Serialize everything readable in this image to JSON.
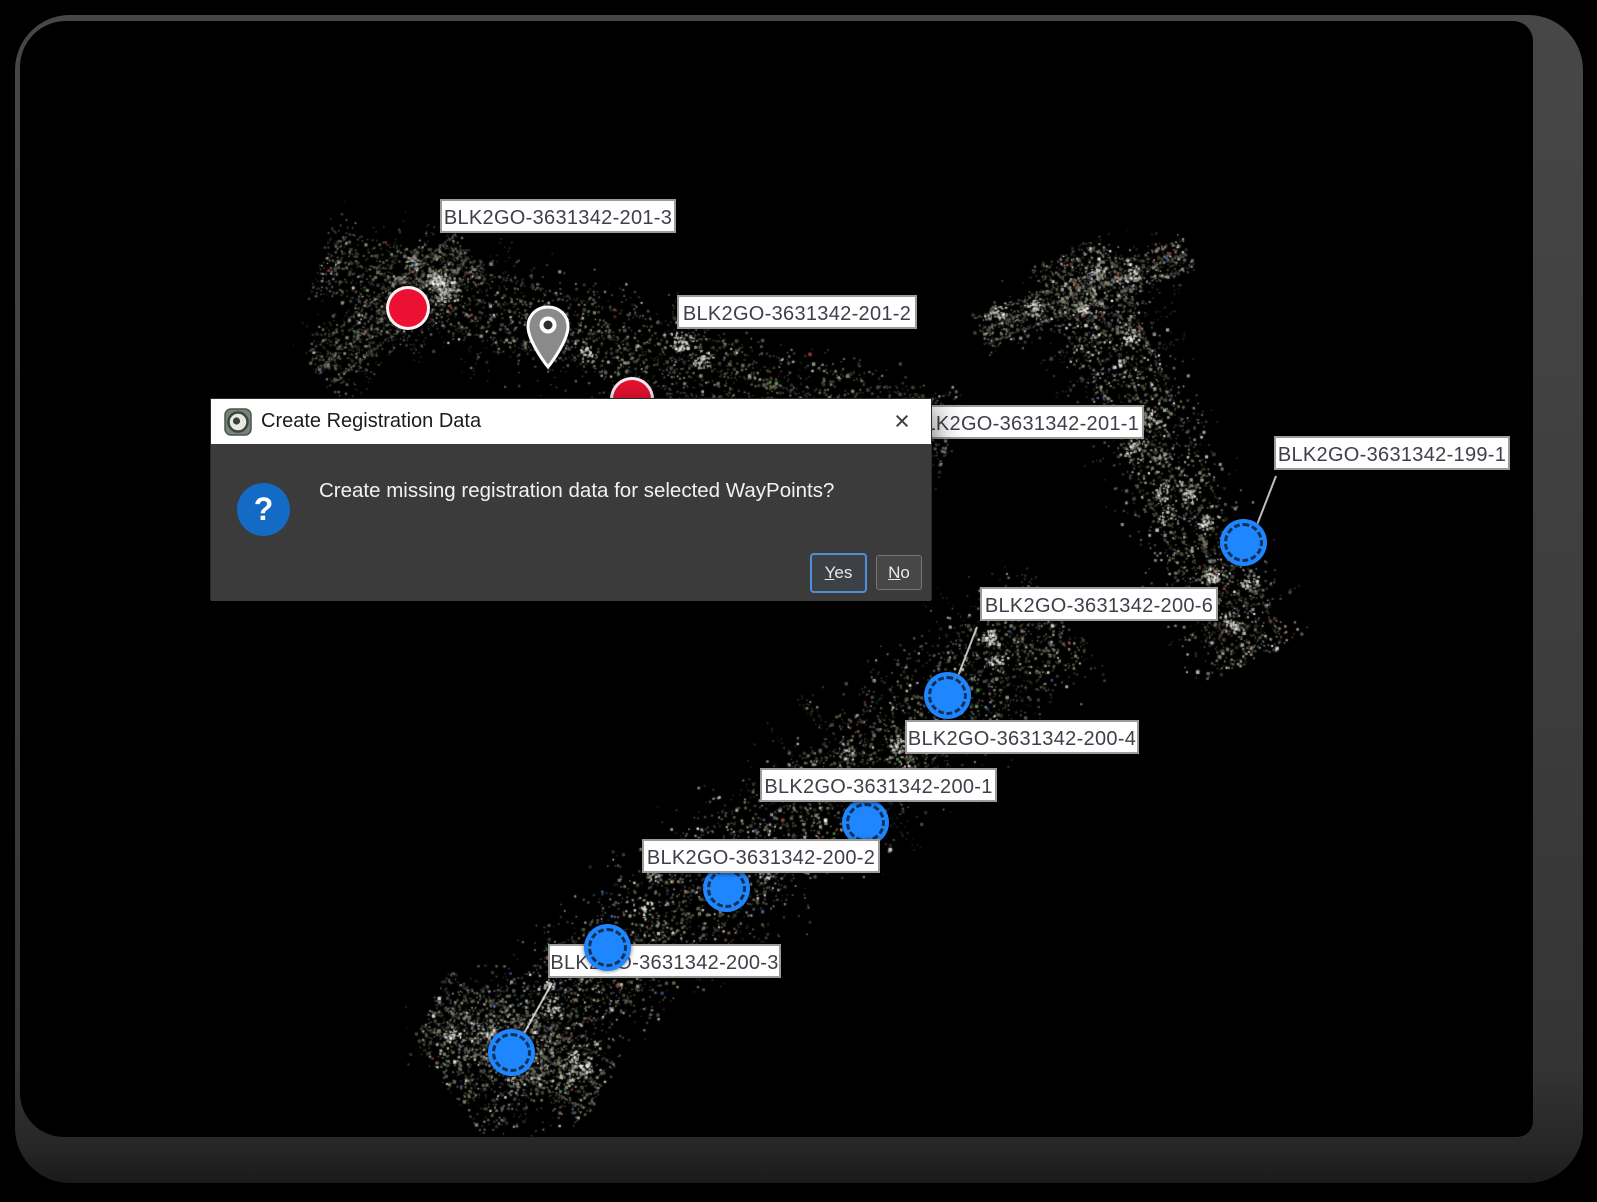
{
  "dialog": {
    "title": "Create Registration Data",
    "message": "Create missing registration data for selected WayPoints?",
    "close_glyph": "×",
    "question_glyph": "?",
    "buttons": [
      {
        "label": "Yes",
        "accesskey": "Y",
        "default": true
      },
      {
        "label": "No",
        "accesskey": "N",
        "default": false
      }
    ]
  },
  "colors": {
    "marker_red": "#ec1132",
    "marker_blue": "#1e86ff",
    "pin_gray": "#8a8a8a",
    "dialog_body": "#3b3b3b",
    "dialog_titlebar": "#ffffff",
    "label_bg": "#ffffff",
    "label_border": "#9b9b9b",
    "question_icon_blue": "#146bc5",
    "yes_button_border": "#4f8fd8",
    "frame_gray": "#3d3d3d"
  },
  "waypoints": {
    "labels": [
      {
        "text": "BLK2GO-3631342-201-3",
        "x": 440,
        "y": 199,
        "w": 236
      },
      {
        "text": "BLK2GO-3631342-201-2",
        "x": 677,
        "y": 295,
        "w": 240
      },
      {
        "text": "BLK2GO-3631342-201-1",
        "x": 906,
        "y": 405,
        "w": 238
      },
      {
        "text": "BLK2GO-3631342-199-1",
        "x": 1274,
        "y": 436,
        "w": 236
      },
      {
        "text": "BLK2GO-3631342-200-6",
        "x": 980,
        "y": 587,
        "w": 238
      },
      {
        "text": "BLK2GO-3631342-200-4",
        "x": 905,
        "y": 720,
        "w": 234
      },
      {
        "text": "BLK2GO-3631342-200-1",
        "x": 760,
        "y": 768,
        "w": 237
      },
      {
        "text": "BLK2GO-3631342-200-2",
        "x": 642,
        "y": 839,
        "w": 238
      },
      {
        "text": "BLK2GO-3631342-200-3",
        "x": 548,
        "y": 944,
        "w": 233
      }
    ],
    "markers": [
      {
        "type": "red",
        "x": 408,
        "y": 308
      },
      {
        "type": "red",
        "x": 632,
        "y": 399
      },
      {
        "type": "pin",
        "x": 548,
        "y": 369
      },
      {
        "type": "blue",
        "x": 1243,
        "y": 542
      },
      {
        "type": "blue",
        "x": 947,
        "y": 695
      },
      {
        "type": "blue",
        "x": 865,
        "y": 822
      },
      {
        "type": "blue",
        "x": 726,
        "y": 888
      },
      {
        "type": "blue",
        "x": 607,
        "y": 947,
        "above_labels": true
      },
      {
        "type": "blue",
        "x": 511,
        "y": 1052
      }
    ],
    "leader_lines": [
      {
        "x1": 1276,
        "y1": 476,
        "x2": 1248,
        "y2": 548
      },
      {
        "x1": 977,
        "y1": 627,
        "x2": 951,
        "y2": 694
      },
      {
        "x1": 552,
        "y1": 983,
        "x2": 517,
        "y2": 1046
      }
    ]
  },
  "point_cloud": {
    "seed": 987654321,
    "palette": [
      "#8a8a7e",
      "#6e6e62",
      "#5a5a50",
      "#b0b0a4",
      "#4c5a42",
      "#6b5a42",
      "#7d7d72",
      "#3e4a5a",
      "#9c8a66",
      "#556048",
      "#444438"
    ],
    "rare_palette": [
      "#c0453a",
      "#4878c8",
      "#6cae5c",
      "#d8d0c0"
    ],
    "clump_palette": [
      "#ffffff",
      "#e8e8e0",
      "#cfd4c6",
      "#aab49a",
      "#d8d8d8"
    ],
    "bands": [
      {
        "x1": 318,
        "y1": 260,
        "x2": 950,
        "y2": 442,
        "half": 62,
        "n": 2600,
        "clumps": 10,
        "bright": 0.1
      },
      {
        "x1": 318,
        "y1": 372,
        "x2": 470,
        "y2": 250,
        "half": 40,
        "n": 700,
        "clumps": 3,
        "bright": 0.08
      },
      {
        "x1": 1066,
        "y1": 250,
        "x2": 1250,
        "y2": 660,
        "half": 64,
        "n": 2400,
        "clumps": 12,
        "bright": 0.22
      },
      {
        "x1": 980,
        "y1": 332,
        "x2": 1188,
        "y2": 254,
        "half": 28,
        "n": 600,
        "clumps": 3,
        "bright": 0.18
      },
      {
        "x1": 450,
        "y1": 1090,
        "x2": 1062,
        "y2": 614,
        "half": 84,
        "n": 4300,
        "clumps": 16,
        "bright": 0.16
      },
      {
        "x1": 432,
        "y1": 1005,
        "x2": 600,
        "y2": 1090,
        "half": 55,
        "n": 900,
        "clumps": 4,
        "bright": 0.12
      }
    ]
  }
}
